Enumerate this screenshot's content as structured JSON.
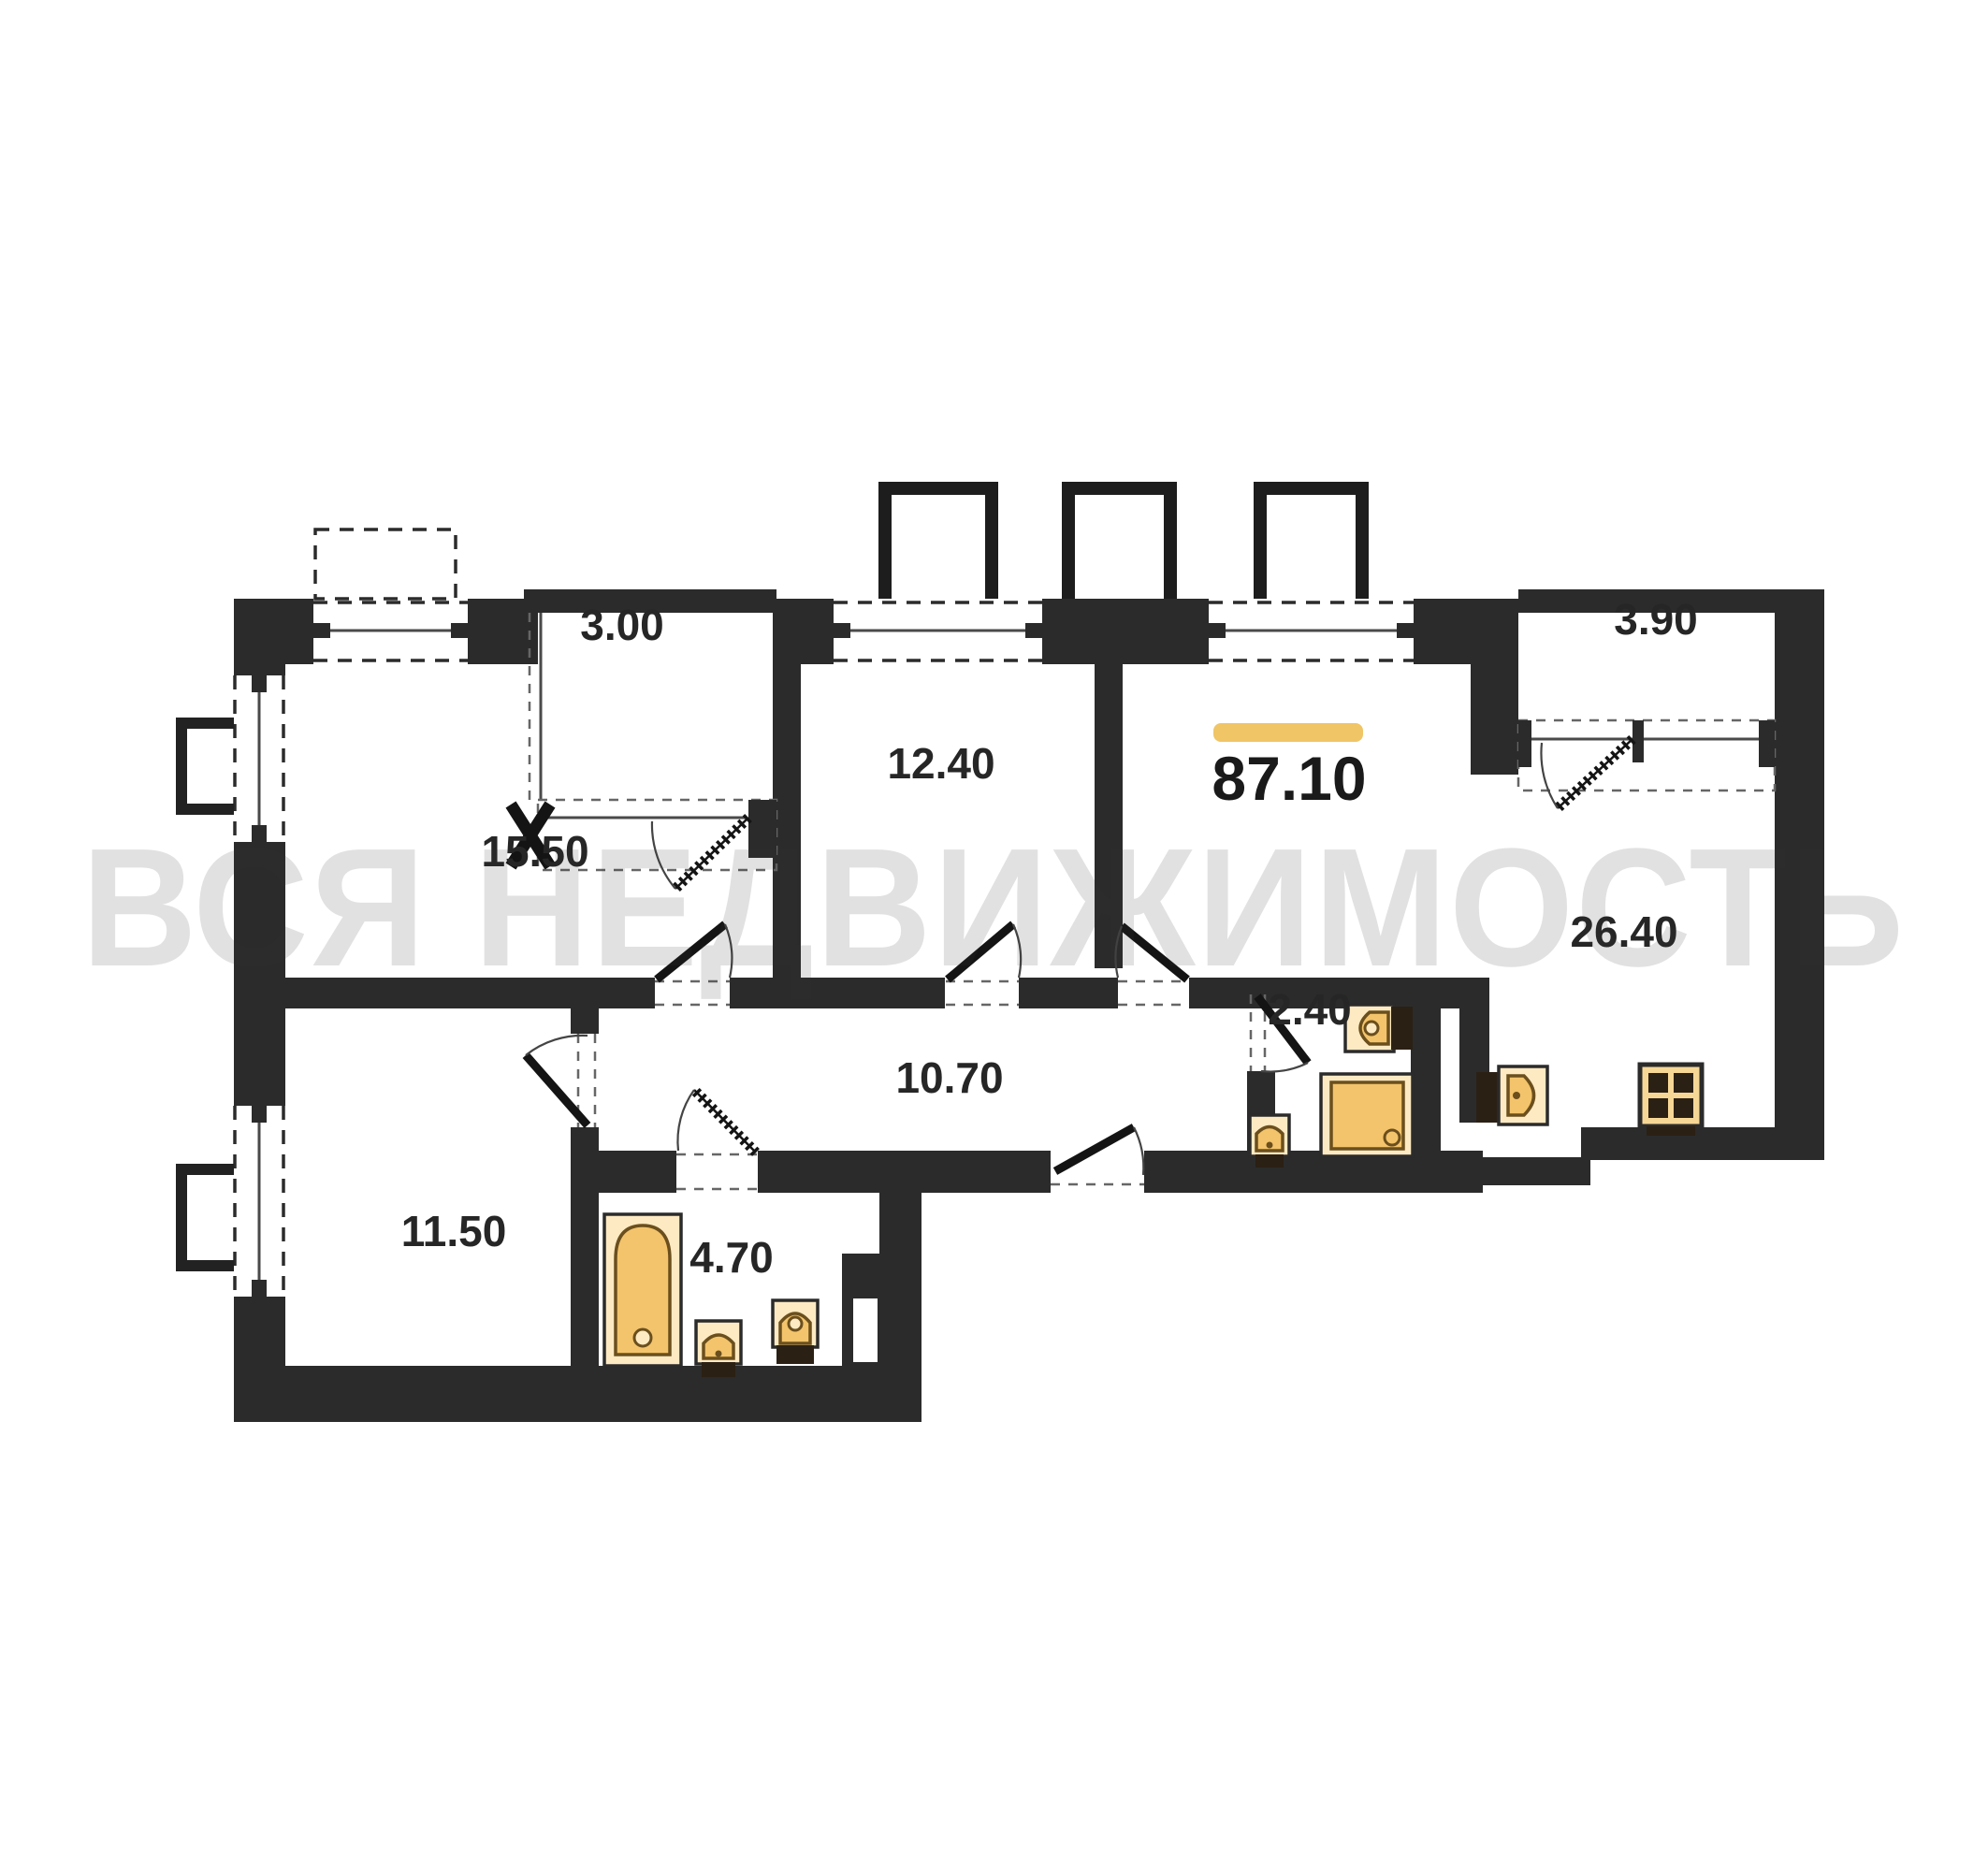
{
  "watermark": {
    "text": "ВСЯ НЕДВИЖИМОСТЬ"
  },
  "total_area": {
    "value": "87.10"
  },
  "rooms": [
    {
      "id": "balcony-top-left",
      "area": "3.00"
    },
    {
      "id": "room-top-left",
      "area": "15.50"
    },
    {
      "id": "room-middle-top",
      "area": "12.40"
    },
    {
      "id": "balcony-top-right",
      "area": "3.90"
    },
    {
      "id": "living-kitchen",
      "area": "26.40"
    },
    {
      "id": "wc",
      "area": "2.40"
    },
    {
      "id": "hallway",
      "area": "10.70"
    },
    {
      "id": "room-bottom-left",
      "area": "11.50"
    },
    {
      "id": "bathroom",
      "area": "4.70"
    }
  ],
  "colors": {
    "wall": "#2b2b2b",
    "accent_bar": "#f0c566",
    "fixture_fill": "#f3c46b",
    "fixture_light": "#fdeac3",
    "watermark_gray": "#d9d9d9"
  }
}
